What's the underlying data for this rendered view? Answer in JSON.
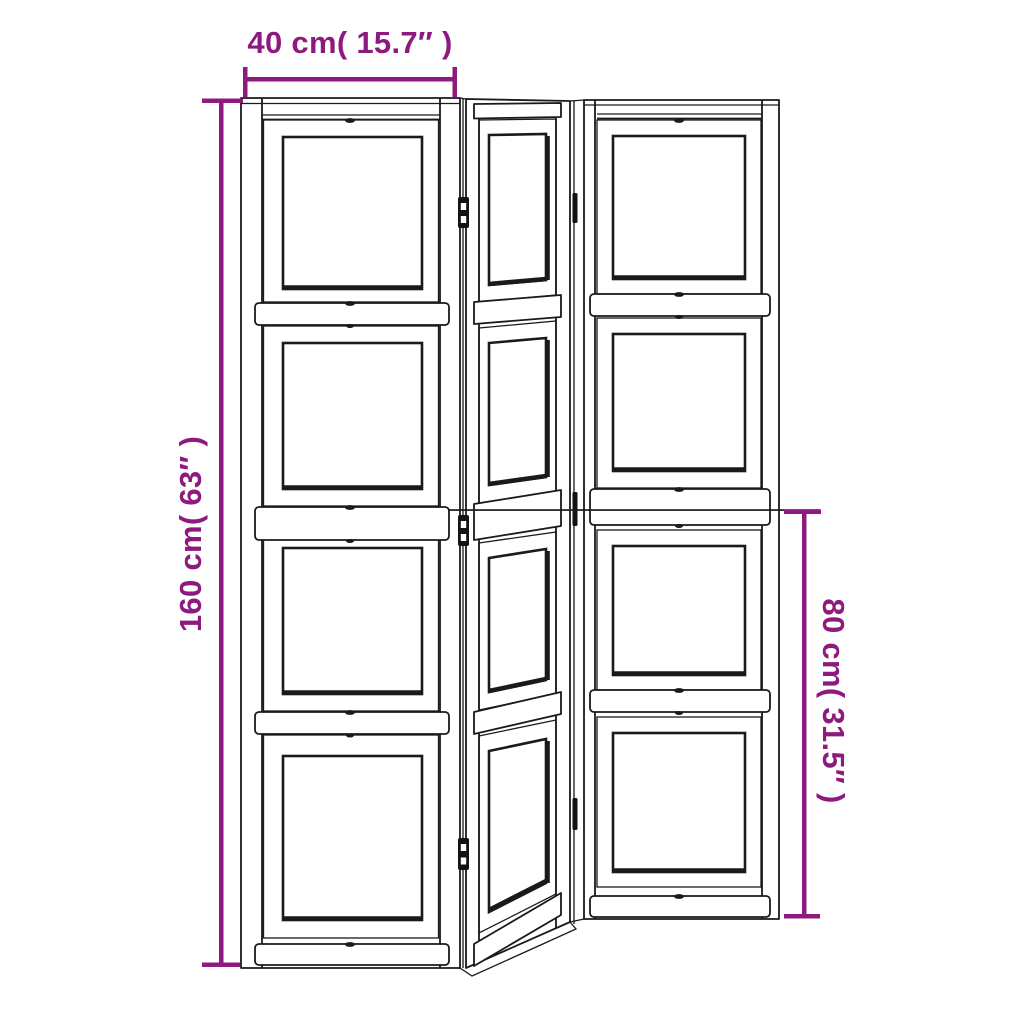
{
  "figure": {
    "description": "Technical line drawing of a 3-panel folding room divider with four framed sections per panel; left panel shown frontal, middle panel angled back, right panel set back",
    "panels": 3,
    "frames_per_panel": 4
  },
  "dimensions": {
    "width": {
      "label": "40 cm( 15.7″ )"
    },
    "height": {
      "label": "160 cm( 63″ )"
    },
    "half_height": {
      "label": "80 cm( 31.5″ )"
    }
  },
  "colors": {
    "dimension_annotation": "#8E1A7F",
    "drawing_line": "#1A1A1A",
    "background": "#FFFFFF"
  }
}
